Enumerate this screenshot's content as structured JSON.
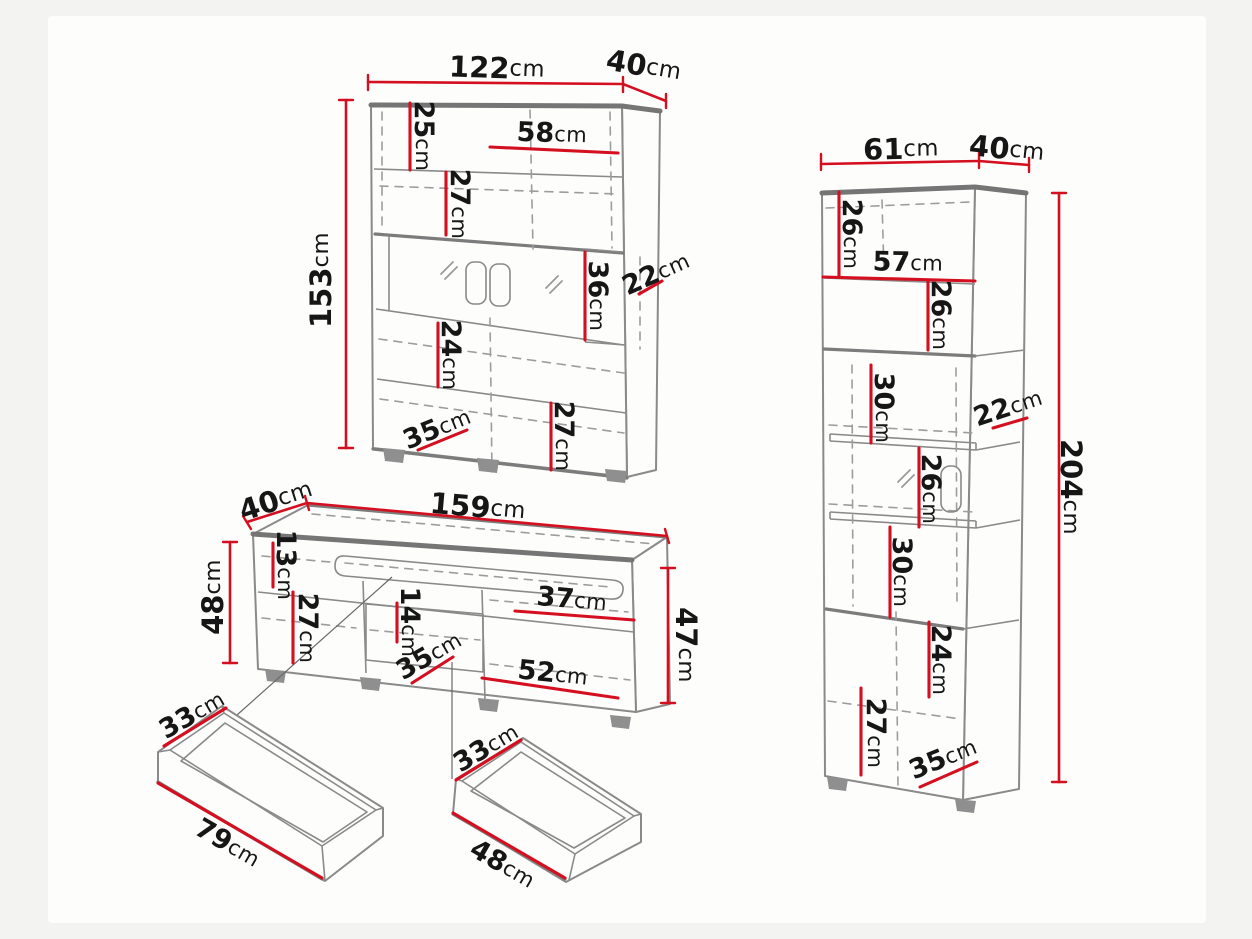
{
  "unit": "cm",
  "colors": {
    "dimension_red": "#d40f20",
    "outline_gray": "#8a8a8a",
    "text": "#161616",
    "background": "#f3f3f1"
  },
  "labels": {
    "wall_cabinet": {
      "width": {
        "v": "122",
        "u": "cm"
      },
      "depth": {
        "v": "40",
        "u": "cm"
      },
      "height": {
        "v": "153",
        "u": "cm"
      },
      "top_shelf": {
        "v": "25",
        "u": "cm"
      },
      "shelf_width": {
        "v": "58",
        "u": "cm"
      },
      "mid_shelf": {
        "v": "27",
        "u": "cm"
      },
      "glass_section": {
        "v": "36",
        "u": "cm"
      },
      "recess_depth": {
        "v": "22",
        "u": "cm"
      },
      "lower_shelf_top": {
        "v": "24",
        "u": "cm"
      },
      "lower_shelf_bottom": {
        "v": "27",
        "u": "cm"
      },
      "inner_depth": {
        "v": "35",
        "u": "cm"
      }
    },
    "tall_cabinet": {
      "width": {
        "v": "61",
        "u": "cm"
      },
      "depth": {
        "v": "40",
        "u": "cm"
      },
      "height": {
        "v": "204",
        "u": "cm"
      },
      "shelf_1": {
        "v": "26",
        "u": "cm"
      },
      "shelf_width": {
        "v": "57",
        "u": "cm"
      },
      "shelf_2": {
        "v": "26",
        "u": "cm"
      },
      "open_shelf_1": {
        "v": "30",
        "u": "cm"
      },
      "open_depth": {
        "v": "22",
        "u": "cm"
      },
      "open_shelf_2": {
        "v": "26",
        "u": "cm"
      },
      "open_shelf_3": {
        "v": "30",
        "u": "cm"
      },
      "lower_shelf_top": {
        "v": "24",
        "u": "cm"
      },
      "lower_shelf_bottom": {
        "v": "27",
        "u": "cm"
      },
      "inner_depth": {
        "v": "35",
        "u": "cm"
      }
    },
    "tv_stand": {
      "depth": {
        "v": "40",
        "u": "cm"
      },
      "width": {
        "v": "159",
        "u": "cm"
      },
      "height_left": {
        "v": "48",
        "u": "cm"
      },
      "flap": {
        "v": "13",
        "u": "cm"
      },
      "door": {
        "v": "27",
        "u": "cm"
      },
      "niche": {
        "v": "14",
        "u": "cm"
      },
      "inner_depth": {
        "v": "35",
        "u": "cm"
      },
      "drawer_width": {
        "v": "37",
        "u": "cm"
      },
      "door_width": {
        "v": "52",
        "u": "cm"
      },
      "height_right": {
        "v": "47",
        "u": "cm"
      }
    },
    "drawer_left": {
      "depth": {
        "v": "33",
        "u": "cm"
      },
      "width": {
        "v": "79",
        "u": "cm"
      }
    },
    "drawer_right": {
      "depth": {
        "v": "33",
        "u": "cm"
      },
      "width": {
        "v": "48",
        "u": "cm"
      }
    }
  }
}
